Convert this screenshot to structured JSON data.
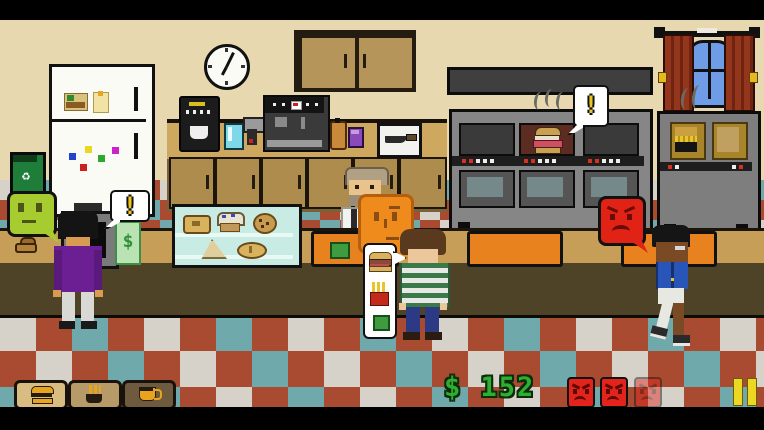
{
  "hud": {
    "money_label": "$ 152",
    "money_value": 152,
    "money_color": "#2faf2f",
    "order_buttons": [
      {
        "id": "burger",
        "icon": "burger-icon"
      },
      {
        "id": "fries",
        "icon": "fries-icon"
      },
      {
        "id": "coffee",
        "icon": "coffee-icon"
      }
    ],
    "anger_meter": {
      "filled": 2,
      "total": 3,
      "color": "#e3241c"
    },
    "pause_icon": "pause-icon",
    "pause_color": "#ecd823"
  },
  "speech": {
    "register_alert": "!",
    "oven_alert": "!",
    "bill_symbol": "$",
    "order_bubble_items": [
      "burger",
      "fries",
      "green-order"
    ]
  },
  "glyphs": {
    "recycle": "♻"
  },
  "scene": {
    "clock": "wall-clock",
    "stations": [
      "register",
      "pastry-display-case",
      "espresso-machine",
      "coffee-maker",
      "oven",
      "fryer"
    ],
    "blob_customers": [
      {
        "color": "#a6cc2f",
        "mood": "neutral"
      },
      {
        "color": "#ef8b1d",
        "mood": "neutral"
      },
      {
        "color": "#e02314",
        "mood": "angry"
      }
    ],
    "oven_status": "burger-cooking-alert"
  },
  "palette": {
    "wall": "#e7d8b0",
    "counter_top": "#c79e57",
    "counter_front": "#4e4326",
    "floor_red": "#a84b31",
    "floor_teal": "#6fa9ac",
    "floor_white": "#d6d2ca",
    "tray_orange": "#e8821e",
    "wood": "#ae8c4e"
  }
}
